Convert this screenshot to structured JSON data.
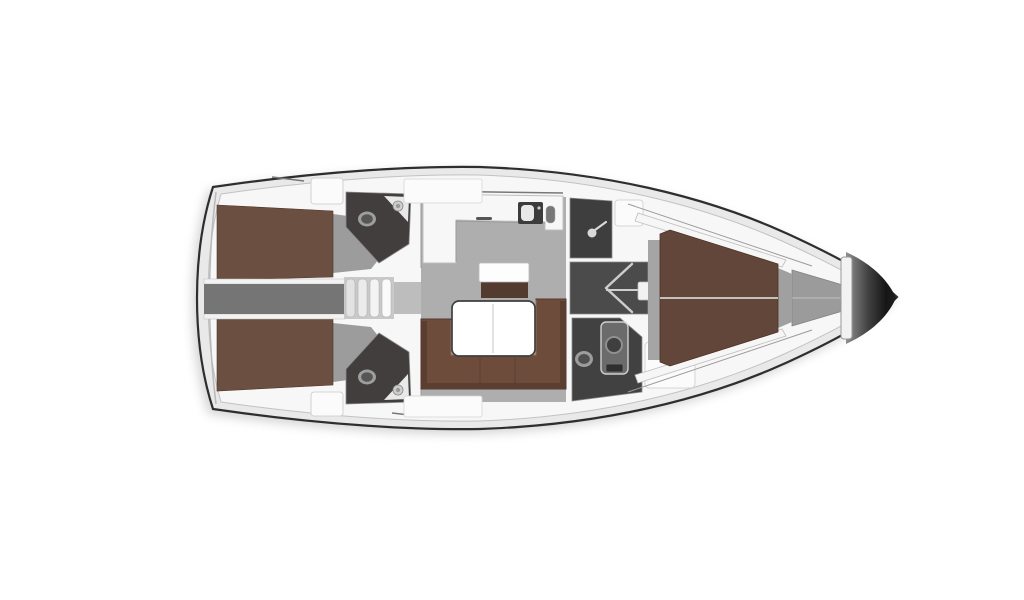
{
  "figure": {
    "kind": "yacht-interior-floor-plan",
    "orientation": "bow-right"
  },
  "palette": {
    "background": "#ffffff",
    "hull_outline": "#2e2e2e",
    "hull_rim": "#e9e9e9",
    "deck_white": "#f7f7f7",
    "floor_gray": "#aeaeae",
    "landing_gray": "#bdbdbd",
    "corridor_gray": "#757575",
    "stair_backdrop": "#c9c9c9",
    "head_dark": "#413e3d",
    "wardrobe_dark": "#4b4b4b",
    "bed_brown": "#6b5042",
    "bed_brown_dark": "#543b2f",
    "sofa_brown": "#6d4c3c",
    "sofa_shadow": "#5a3f31",
    "table_white": "#ffffff",
    "fixture_light": "#e9e9e9",
    "fixture_mid": "#8f8f8f",
    "locker_white": "#fbfbfb",
    "anchor_gray": "#9b9b9b",
    "bow_dark": "#141414",
    "wall_stroke": "#8a8a8a"
  },
  "icons": {
    "toilet-icon": "double-ellipse",
    "sink-icon": "circle-basin",
    "shower-head-icon": "circle-with-arm",
    "hanging-locker-icon": "left-chevron",
    "galley-sink-icon": "dark-square-white-basin",
    "galley-faucet-icon": "vertical-pill",
    "stair-tread-icon": "vertical-bar"
  }
}
